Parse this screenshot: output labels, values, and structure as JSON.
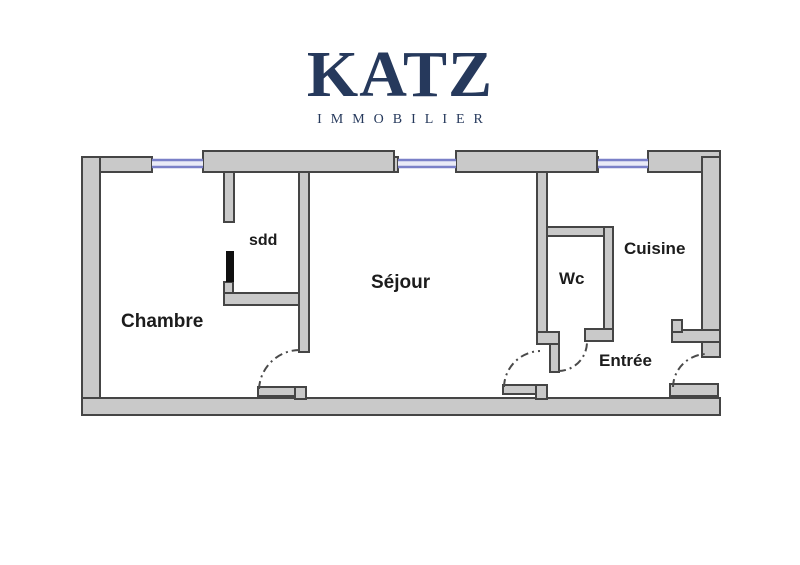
{
  "logo": {
    "brand": "KATZ",
    "tagline": "IMMOBILIER",
    "color": "#26395c"
  },
  "floorplan": {
    "rooms": [
      {
        "id": "chambre",
        "label": "Chambre"
      },
      {
        "id": "sdd",
        "label": "sdd"
      },
      {
        "id": "sejour",
        "label": "Séjour"
      },
      {
        "id": "wc",
        "label": "Wc"
      },
      {
        "id": "cuisine",
        "label": "Cuisine"
      },
      {
        "id": "entree",
        "label": "Entrée"
      }
    ],
    "windows_count": 3,
    "doors_count": 5,
    "colors": {
      "wall_fill": "#c9c9c9",
      "wall_stroke": "#454545",
      "window_line": "#7a80c8",
      "window_fill": "#e9eaf7",
      "door_leaf_black": "#101010",
      "label_text": "#1c1c1c"
    }
  }
}
